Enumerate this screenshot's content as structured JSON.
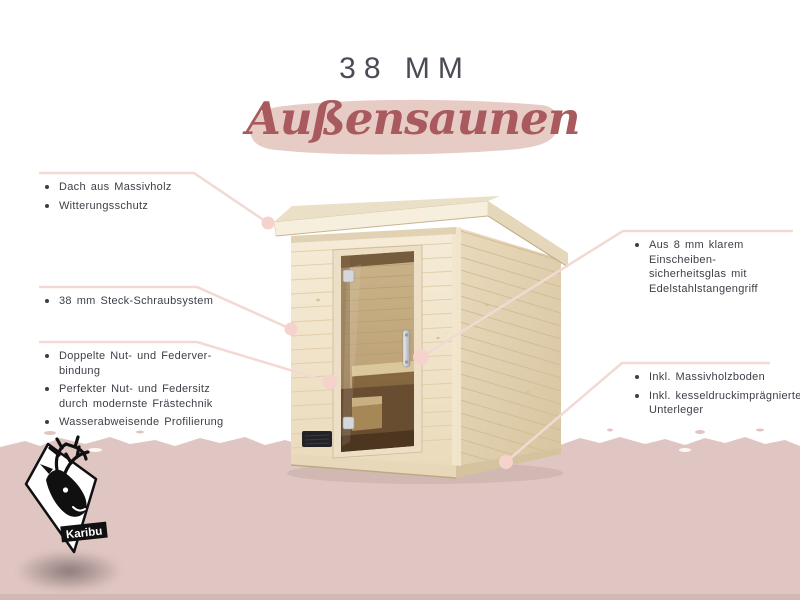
{
  "title": {
    "size": "38 MM",
    "name": "Außensaunen"
  },
  "features": {
    "left_top": [
      "Dach aus Massivholz",
      "Witterungsschutz"
    ],
    "left_middle": [
      "38 mm Steck-Schraubsystem"
    ],
    "left_bottom": [
      "Doppelte Nut- und Federver-\nbindung",
      "Perfekter Nut- und Federsitz\ndurch modernste Frästechnik",
      "Wasserabweisende Profilierung"
    ],
    "right_top": [
      "Aus 8 mm klarem Einscheiben-\nsicherheitsglas mit\nEdelstahlstangengriff"
    ],
    "right_bottom": [
      "Inkl. Massivholzboden",
      "Inkl. kesseldruckimprägnierter\nUnterleger"
    ]
  },
  "logo": {
    "brand": "Karibu"
  },
  "colors": {
    "background_bottom": "#e0c6c2",
    "brush_stroke": "#e7cbc5",
    "script_text": "#a85a5e",
    "title_text": "#4b4b56",
    "label_text": "#3e3e48",
    "leader_line": "#f3d9d4",
    "connector_dot": "#f5d2cc",
    "wood_light": "#f3e8d2",
    "wood_side": "#e2d1b2"
  }
}
